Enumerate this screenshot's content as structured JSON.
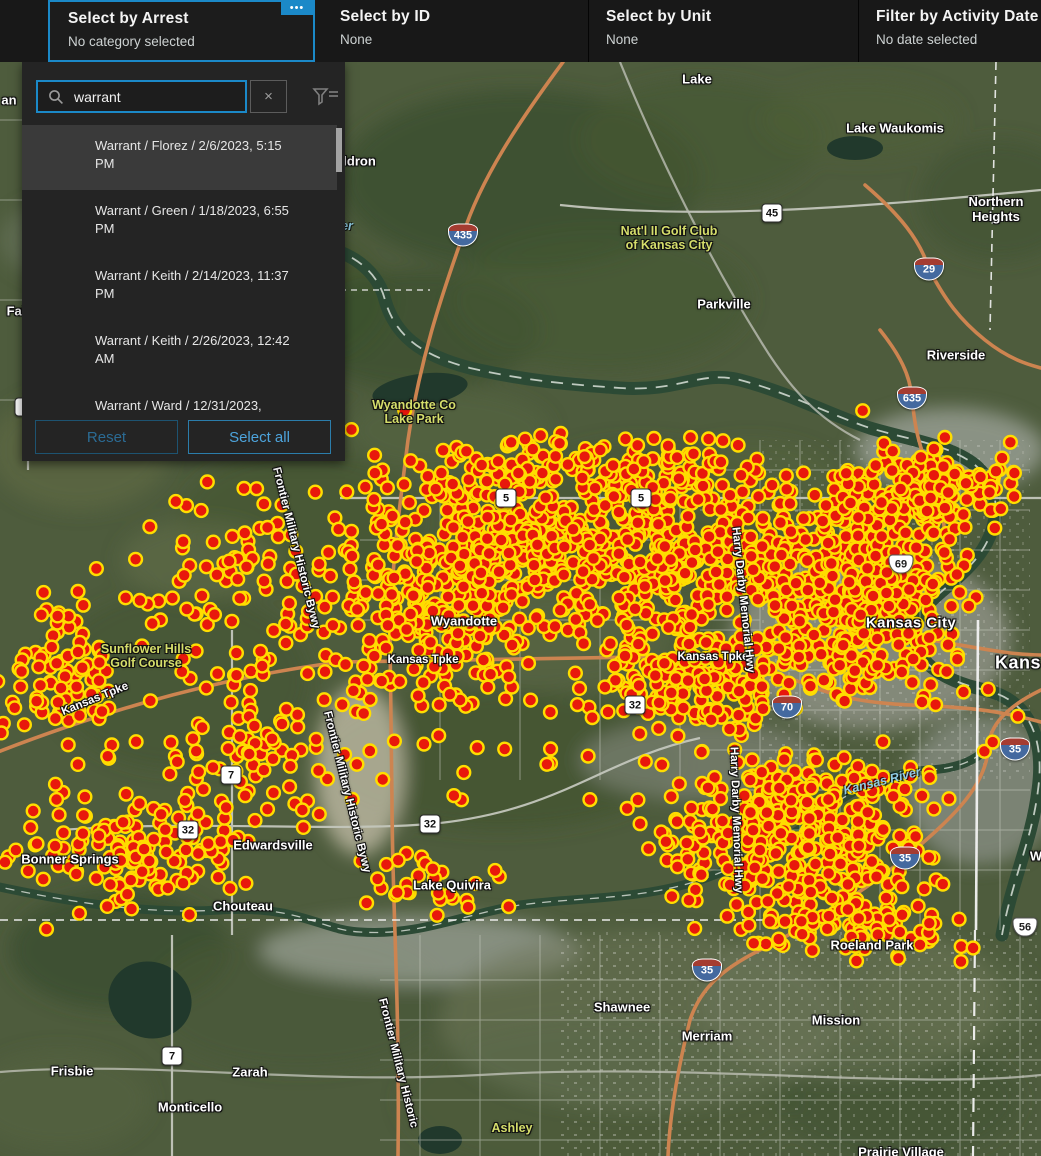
{
  "header": {
    "menu_button_label": "•••",
    "sections": [
      {
        "title": "Select by Arrest",
        "subtitle": "No category selected",
        "selected": true
      },
      {
        "title": "Select by ID",
        "subtitle": "None",
        "selected": false
      },
      {
        "title": "Select by Unit",
        "subtitle": "None",
        "selected": false
      },
      {
        "title": "Filter by Activity Date",
        "subtitle": "No date selected",
        "selected": false
      }
    ]
  },
  "panel": {
    "search": {
      "value": "warrant"
    },
    "clear_label": "×",
    "items": [
      {
        "text": "Warrant / Florez / 2/6/2023, 5:15 PM",
        "selected": true
      },
      {
        "text": "Warrant / Green / 1/18/2023, 6:55 PM",
        "selected": false
      },
      {
        "text": "Warrant / Keith / 2/14/2023, 11:37 PM",
        "selected": false
      },
      {
        "text": "Warrant / Keith / 2/26/2023, 12:42 AM",
        "selected": false
      },
      {
        "text": "Warrant / Ward / 12/31/2023, 10:55 PM",
        "selected": false,
        "clipped": true
      }
    ],
    "buttons": {
      "reset": "Reset",
      "select_all": "Select all"
    },
    "reset_disabled": true
  },
  "map": {
    "colors": {
      "accent_blue": "#1b89c8",
      "dot_fill": "#e8180c",
      "dot_ring": "#ffdd00",
      "land": "#4e5c3d",
      "river": "#2c4a35"
    },
    "labels": [
      {
        "text": "Lake",
        "x": 697,
        "y": 79,
        "type": "city"
      },
      {
        "text": "Lake Waukomis",
        "x": 895,
        "y": 128,
        "type": "city"
      },
      {
        "text": "Waldron",
        "x": 350,
        "y": 161,
        "type": "city"
      },
      {
        "text": "Northern\nHeights",
        "x": 996,
        "y": 209,
        "type": "city"
      },
      {
        "text": "Nat'l II Golf Club\nof Kansas City",
        "x": 669,
        "y": 238,
        "type": "golf"
      },
      {
        "text": "er",
        "x": 347,
        "y": 226,
        "type": "water"
      },
      {
        "text": "an",
        "x": 9,
        "y": 100,
        "type": "city"
      },
      {
        "text": "Parkville",
        "x": 724,
        "y": 304,
        "type": "city"
      },
      {
        "text": "Riverside",
        "x": 956,
        "y": 355,
        "type": "city"
      },
      {
        "text": "Fai",
        "x": 16,
        "y": 311,
        "type": "city"
      },
      {
        "text": "Wyandotte Co\nLake Park",
        "x": 414,
        "y": 412,
        "type": "golf"
      },
      {
        "text": "Wyandotte",
        "x": 464,
        "y": 621,
        "type": "city"
      },
      {
        "text": "Kansas Tpke",
        "x": 423,
        "y": 660,
        "type": "road"
      },
      {
        "text": "Kansas Tpke",
        "x": 713,
        "y": 657,
        "type": "road"
      },
      {
        "text": "Kansas Tpke",
        "x": 95,
        "y": 699,
        "type": "road",
        "rot": -22
      },
      {
        "text": "Kansas City",
        "x": 911,
        "y": 623,
        "type": "city big"
      },
      {
        "text": "Kans",
        "x": 1018,
        "y": 663,
        "type": "city huge"
      },
      {
        "text": "Sunflower Hills\nGolf Course",
        "x": 146,
        "y": 656,
        "type": "golf"
      },
      {
        "text": "Harry Darby Memorial Hwy",
        "x": 743,
        "y": 600,
        "type": "road",
        "rot": 84
      },
      {
        "text": "Harry Darby Memorial Hwy",
        "x": 736,
        "y": 820,
        "type": "road",
        "rot": 88
      },
      {
        "text": "Frontier Military Historic Bywy",
        "x": 296,
        "y": 548,
        "type": "road",
        "rot": 76
      },
      {
        "text": "Frontier Military Historic Bywy",
        "x": 347,
        "y": 792,
        "type": "road",
        "rot": 76
      },
      {
        "text": "Frontier Military Historic",
        "x": 398,
        "y": 1063,
        "type": "road",
        "rot": 76
      },
      {
        "text": "Kansas River",
        "x": 882,
        "y": 781,
        "type": "water",
        "rot": -14
      },
      {
        "text": "Bonner Springs",
        "x": 70,
        "y": 859,
        "type": "city"
      },
      {
        "text": "Edwardsville",
        "x": 273,
        "y": 845,
        "type": "city"
      },
      {
        "text": "Lake Quivira",
        "x": 452,
        "y": 885,
        "type": "city"
      },
      {
        "text": "Chouteau",
        "x": 243,
        "y": 906,
        "type": "city"
      },
      {
        "text": "Shawnee",
        "x": 622,
        "y": 1007,
        "type": "city"
      },
      {
        "text": "Merriam",
        "x": 707,
        "y": 1036,
        "type": "city"
      },
      {
        "text": "Mission",
        "x": 836,
        "y": 1020,
        "type": "city"
      },
      {
        "text": "Roeland Park",
        "x": 872,
        "y": 945,
        "type": "city"
      },
      {
        "text": "Frisbie",
        "x": 72,
        "y": 1071,
        "type": "city"
      },
      {
        "text": "Zarah",
        "x": 250,
        "y": 1072,
        "type": "city"
      },
      {
        "text": "Monticello",
        "x": 190,
        "y": 1107,
        "type": "city"
      },
      {
        "text": "Ashley",
        "x": 512,
        "y": 1128,
        "type": "golf"
      },
      {
        "text": "Prairie Village",
        "x": 901,
        "y": 1152,
        "type": "city"
      },
      {
        "text": "W",
        "x": 1036,
        "y": 856,
        "type": "city"
      }
    ],
    "shields": [
      {
        "t": "i",
        "n": "435",
        "x": 463,
        "y": 235
      },
      {
        "t": "i",
        "n": "29",
        "x": 929,
        "y": 269
      },
      {
        "t": "i",
        "n": "635",
        "x": 912,
        "y": 398
      },
      {
        "t": "i",
        "n": "70",
        "x": 787,
        "y": 707
      },
      {
        "t": "i",
        "n": "35",
        "x": 1015,
        "y": 749
      },
      {
        "t": "i",
        "n": "35",
        "x": 905,
        "y": 858
      },
      {
        "t": "i",
        "n": "35",
        "x": 707,
        "y": 970
      },
      {
        "t": "us",
        "n": "69",
        "x": 901,
        "y": 564
      },
      {
        "t": "us",
        "n": "56",
        "x": 1025,
        "y": 927
      },
      {
        "t": "s",
        "n": "45",
        "x": 772,
        "y": 213
      },
      {
        "t": "s",
        "n": "5",
        "x": 506,
        "y": 498
      },
      {
        "t": "s",
        "n": "5",
        "x": 641,
        "y": 498
      },
      {
        "t": "s",
        "n": "32",
        "x": 635,
        "y": 705
      },
      {
        "t": "s",
        "n": "32",
        "x": 188,
        "y": 830
      },
      {
        "t": "s",
        "n": "32",
        "x": 430,
        "y": 824
      },
      {
        "t": "s",
        "n": "7",
        "x": 25,
        "y": 407
      },
      {
        "t": "s",
        "n": "7",
        "x": 231,
        "y": 775
      },
      {
        "t": "s",
        "n": "7",
        "x": 172,
        "y": 1056
      }
    ],
    "dot_style": {
      "radius": 6.4,
      "ring_width": 2.4
    },
    "dot_clusters": [
      {
        "cx": 500,
        "cy": 555,
        "rx": 165,
        "ry": 95,
        "n": 330
      },
      {
        "cx": 670,
        "cy": 560,
        "rx": 140,
        "ry": 110,
        "n": 380
      },
      {
        "cx": 860,
        "cy": 590,
        "rx": 125,
        "ry": 130,
        "n": 500
      },
      {
        "cx": 800,
        "cy": 840,
        "rx": 165,
        "ry": 95,
        "n": 430
      },
      {
        "cx": 420,
        "cy": 630,
        "rx": 110,
        "ry": 95,
        "n": 160
      },
      {
        "cx": 240,
        "cy": 600,
        "rx": 125,
        "ry": 120,
        "n": 90
      },
      {
        "cx": 60,
        "cy": 680,
        "rx": 75,
        "ry": 110,
        "n": 90
      },
      {
        "cx": 130,
        "cy": 855,
        "rx": 140,
        "ry": 75,
        "n": 150
      },
      {
        "cx": 560,
        "cy": 470,
        "rx": 230,
        "ry": 45,
        "n": 140
      },
      {
        "cx": 930,
        "cy": 490,
        "rx": 95,
        "ry": 55,
        "n": 150
      },
      {
        "cx": 700,
        "cy": 680,
        "rx": 120,
        "ry": 60,
        "n": 170
      },
      {
        "cx": 520,
        "cy": 640,
        "rx": 520,
        "ry": 260,
        "n": 120
      },
      {
        "cx": 270,
        "cy": 760,
        "rx": 120,
        "ry": 80,
        "n": 70
      },
      {
        "cx": 860,
        "cy": 930,
        "rx": 120,
        "ry": 40,
        "n": 80
      },
      {
        "cx": 430,
        "cy": 880,
        "rx": 90,
        "ry": 40,
        "n": 30
      }
    ]
  }
}
